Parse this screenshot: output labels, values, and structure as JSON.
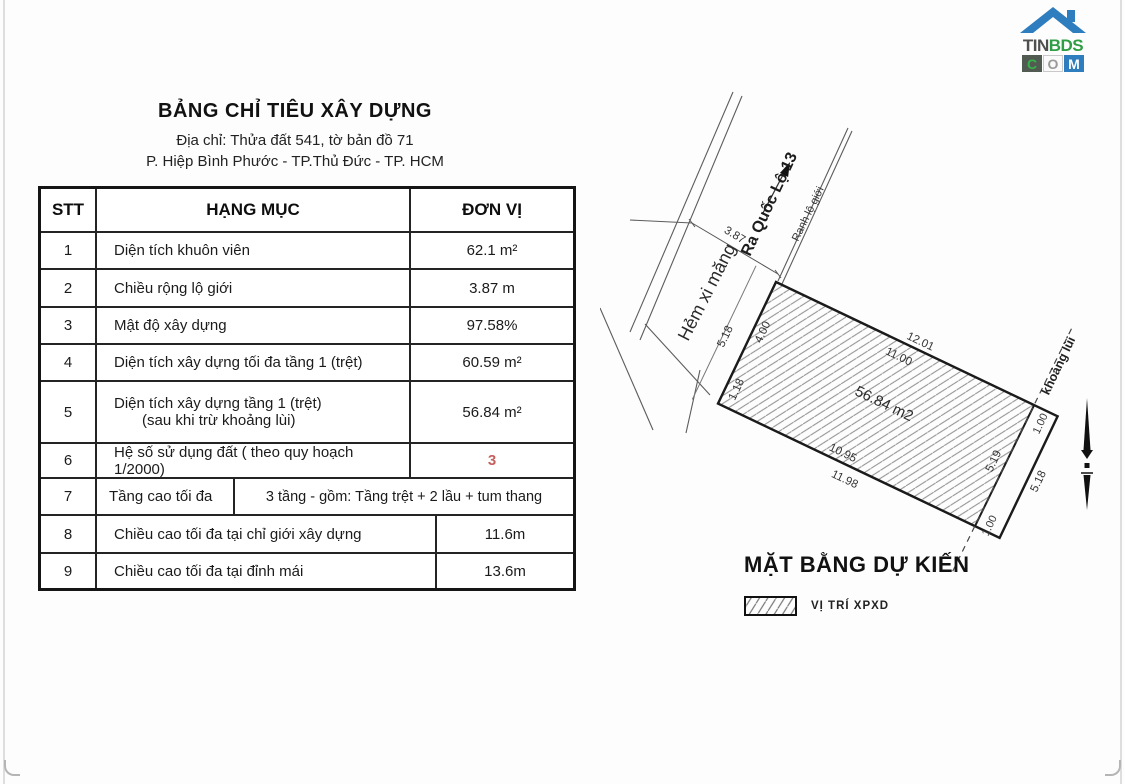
{
  "logo": {
    "tin": "TIN",
    "bds": "BDS",
    "c": "C",
    "o": "O",
    "m": "M"
  },
  "header": {
    "title": "BẢNG CHỈ TIÊU XÂY DỰNG",
    "address1": "Địa chỉ: Thửa đất 541, tờ bản đồ 71",
    "address2": "P. Hiệp Bình Phước - TP.Thủ Đức - TP. HCM"
  },
  "table": {
    "columns": [
      "STT",
      "HẠNG MỤC",
      "ĐƠN VỊ"
    ],
    "rows": [
      {
        "no": "1",
        "label": "Diện tích khuôn viên",
        "value": "62.1 m²"
      },
      {
        "no": "2",
        "label": "Chiều rộng lộ giới",
        "value": "3.87 m"
      },
      {
        "no": "3",
        "label": "Mật độ xây dựng",
        "value": "97.58%"
      },
      {
        "no": "4",
        "label": "Diện tích xây dựng tối đa tầng 1 (trệt)",
        "value": "60.59 m²"
      },
      {
        "no": "5",
        "label": "Diện tích xây dựng tầng 1 (trệt)",
        "label2": "(sau khi trừ khoảng lùi)",
        "value": "56.84 m²"
      },
      {
        "no": "6",
        "label": "Hệ số sử dụng đất ( theo quy hoạch 1/2000)",
        "value": "3"
      },
      {
        "no": "7",
        "label": "Tầng cao tối đa",
        "value": "3 tầng - gồm: Tầng trệt  + 2 lầu + tum thang"
      },
      {
        "no": "8",
        "label": "Chiều cao tối đa tại chỉ giới xây dựng",
        "value": "11.6m"
      },
      {
        "no": "9",
        "label": "Chiều cao tối đa tại đỉnh mái",
        "value": "13.6m"
      }
    ]
  },
  "plan": {
    "title": "MẶT BẰNG DỰ KIẾN",
    "legend_label": "VỊ TRÍ XPXD",
    "road_name": "Hẻm xi măng",
    "direction_label": "Ra Quốc Lộ 13",
    "boundary_label": "Ranh lộ giới",
    "road_width": "3.87",
    "setback_label": "khoảng lùi",
    "area": "56.84 m2",
    "dims": {
      "top_outer": "12.01",
      "top_inner": "11.00",
      "bottom_inner": "10.95",
      "bottom_outer": "11.98",
      "left_outer": "5.18",
      "left_upper": "4.00",
      "left_lower": "1.18",
      "right_inner": "5.19",
      "right_outer": "5.18",
      "setback_top": "1.00",
      "setback_bottom": "1.00"
    }
  },
  "colors": {
    "accent_red": "#c4605e",
    "brand_blue": "#2e7dbe",
    "brand_green": "#2f9e45"
  }
}
